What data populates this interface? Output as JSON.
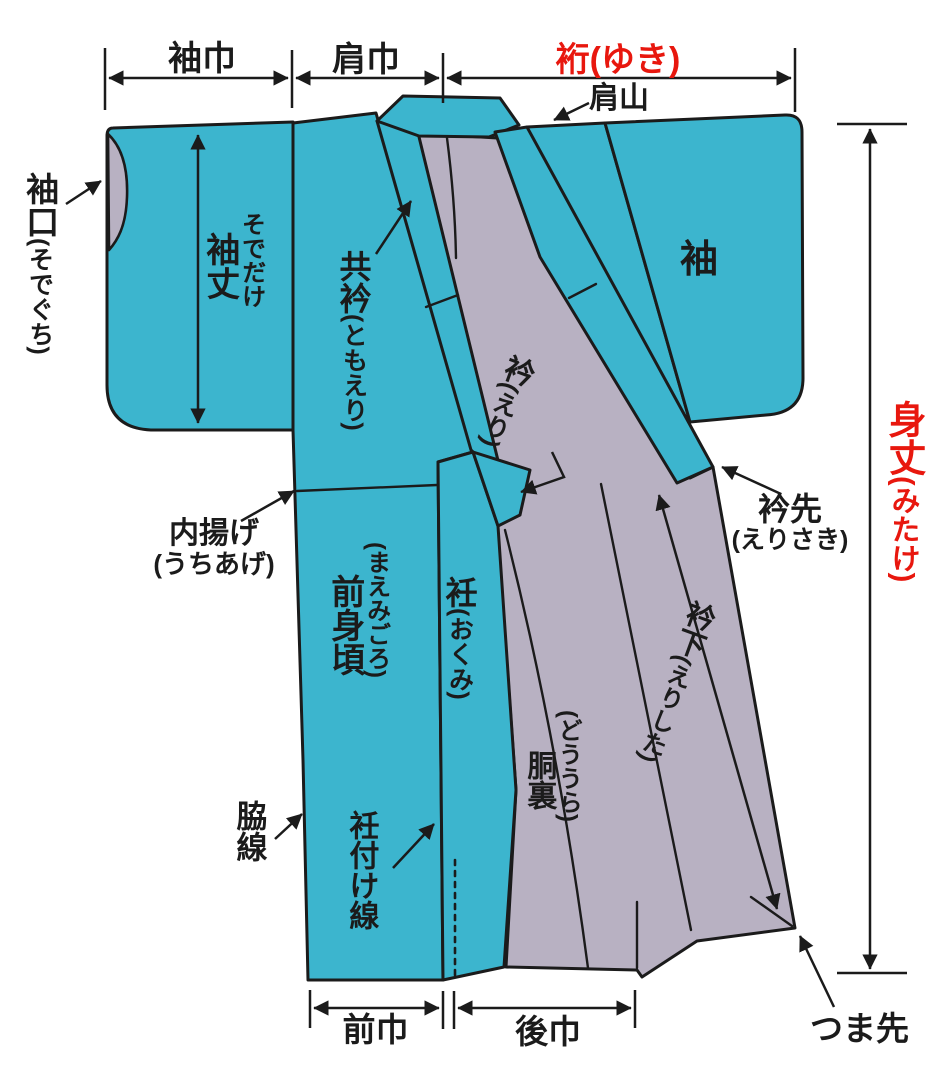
{
  "colors": {
    "fabric_teal": "#3cb5ce",
    "lining_gray": "#b8b1c2",
    "outline_black": "#1b1b1b",
    "accent_red": "#e8170e"
  },
  "measurements": {
    "sode_haba": "袖巾",
    "kata_haba": "肩巾",
    "yuki": "裄(ゆき)",
    "mitake_kanji": "身丈",
    "mitake_kana": "(みたけ)",
    "sodetake_kana": "そでだけ",
    "sodetake_kanji": "袖丈",
    "mae_haba": "前巾",
    "ushiro_haba": "後巾"
  },
  "parts": {
    "katayama": "肩山",
    "sodeguchi_kanji": "袖口",
    "sodeguchi_kana": "(そでぐち)",
    "tomoeri_kanji": "共衿",
    "tomoeri_kana": "(ともえり)",
    "eri_kanji": "衿",
    "eri_kana": "(えり)",
    "sode": "袖",
    "uchiage_kanji": "内揚げ",
    "uchiage_kana": "(うちあげ)",
    "erisaki_kanji": "衿先",
    "erisaki_kana": "(えりさき)",
    "maemigoro_kana": "(まえみごろ)",
    "maemigoro_kanji": "前身頃",
    "okumi_kanji": "衽",
    "okumi_kana": "(おくみ)",
    "douura_kana": "(どううら)",
    "douura_kanji": "胴裏",
    "erishita_kanji": "衿下",
    "erishita_kana": "(えりした)",
    "wakisen": "脇線",
    "okumi_tsuke_sen": "衽付け線",
    "tsumasaki": "つま先"
  }
}
